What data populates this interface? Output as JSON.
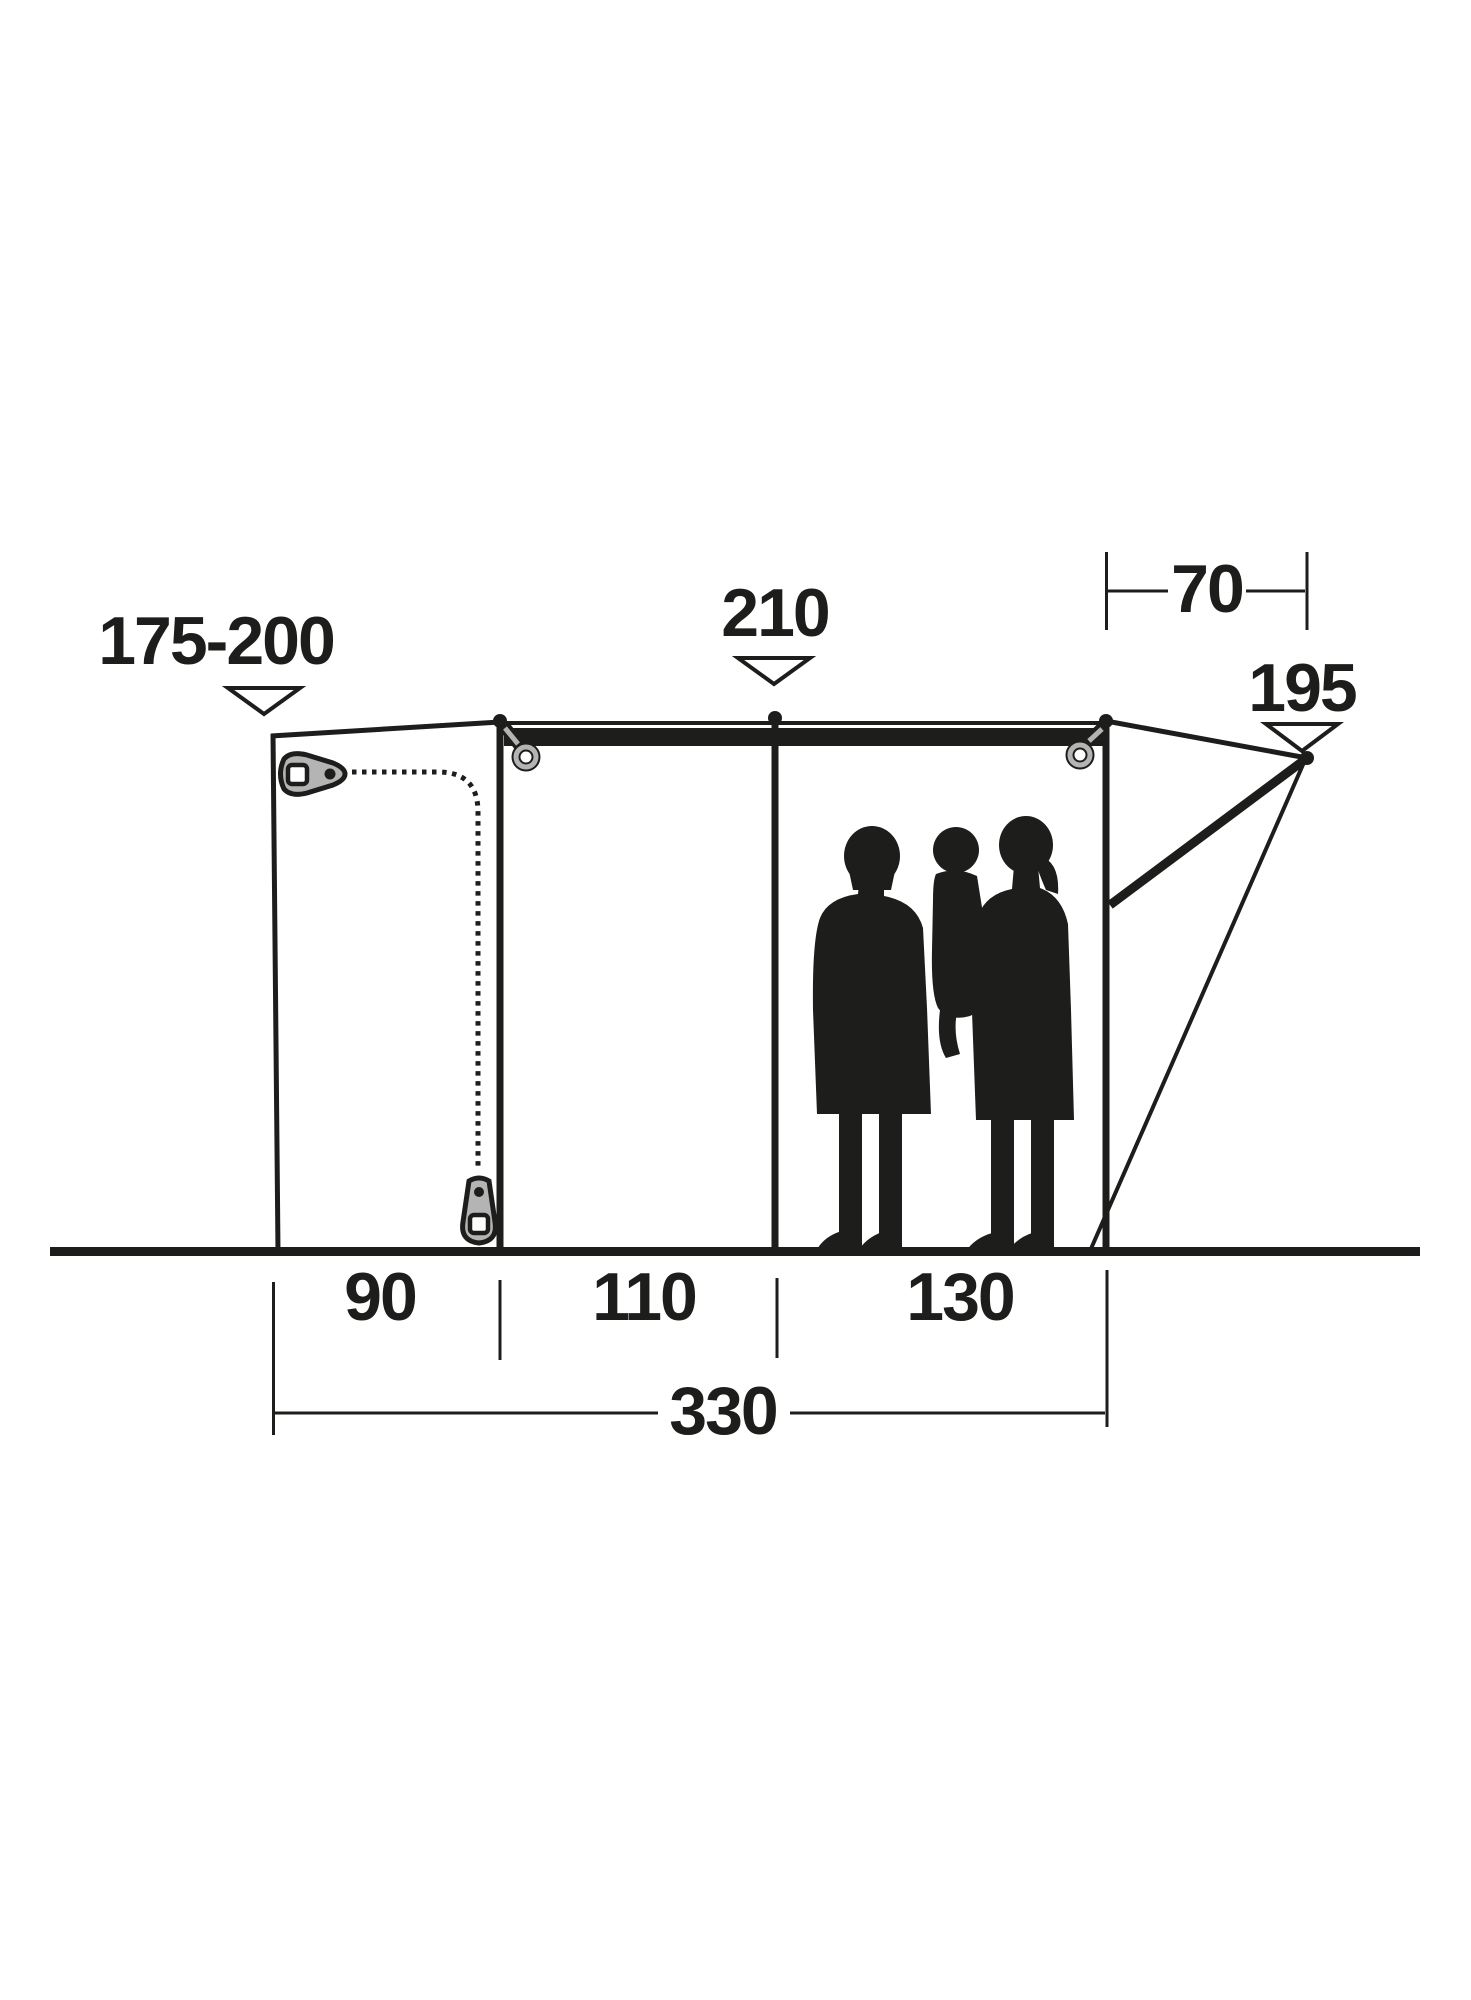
{
  "diagram": {
    "labels": {
      "rear_height": "175-200",
      "peak_height": "210",
      "canopy_depth": "70",
      "front_height": "195",
      "section_rear": "90",
      "section_middle": "110",
      "section_front": "130",
      "total_length": "330"
    },
    "icons": {
      "markers": "triangle-down-marker",
      "zipper_top": "zipper-slider-icon",
      "zipper_bottom": "zipper-pull-icon",
      "rings": "grommet-ring-icon"
    },
    "colors": {
      "ink": "#1d1d1b",
      "gray": "#b4b4b4",
      "background": "#ffffff"
    }
  }
}
